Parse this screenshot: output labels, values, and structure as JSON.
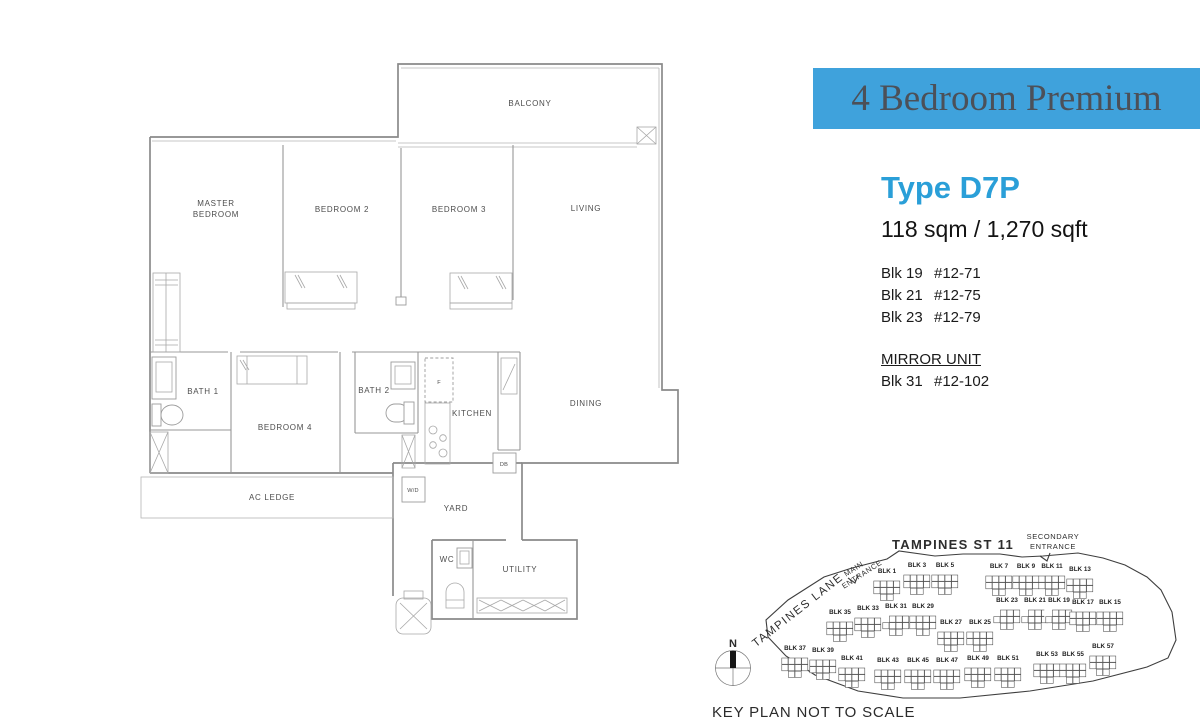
{
  "banner": {
    "title": "4 Bedroom Premium",
    "bg_color": "#3fa2dc",
    "text_color": "#4c5058"
  },
  "unit_info": {
    "type_label": "Type D7P",
    "accent_color": "#2a9fd8",
    "area": "118 sqm / 1,270 sqft",
    "blocks": [
      {
        "blk": "Blk 19",
        "unit": "#12-71"
      },
      {
        "blk": "Blk 21",
        "unit": "#12-75"
      },
      {
        "blk": "Blk 23",
        "unit": "#12-79"
      }
    ],
    "mirror_label": "MIRROR UNIT",
    "mirror_block": {
      "blk": "Blk 31",
      "unit": "#12-102"
    }
  },
  "floor_plan": {
    "labels": [
      {
        "text": "BALCONY",
        "x": 530,
        "y": 106
      },
      {
        "text": "MASTER",
        "x": 216,
        "y": 206
      },
      {
        "text": "BEDROOM",
        "x": 216,
        "y": 217
      },
      {
        "text": "BEDROOM 2",
        "x": 342,
        "y": 212
      },
      {
        "text": "BEDROOM 3",
        "x": 459,
        "y": 212
      },
      {
        "text": "LIVING",
        "x": 586,
        "y": 211
      },
      {
        "text": "BATH 1",
        "x": 203,
        "y": 394
      },
      {
        "text": "BEDROOM 4",
        "x": 285,
        "y": 430
      },
      {
        "text": "BATH 2",
        "x": 374,
        "y": 393
      },
      {
        "text": "KITCHEN",
        "x": 472,
        "y": 416
      },
      {
        "text": "DINING",
        "x": 586,
        "y": 406
      },
      {
        "text": "AC LEDGE",
        "x": 272,
        "y": 500
      },
      {
        "text": "YARD",
        "x": 456,
        "y": 511
      },
      {
        "text": "WC",
        "x": 447,
        "y": 562
      },
      {
        "text": "UTILITY",
        "x": 520,
        "y": 572
      },
      {
        "text": "F",
        "x": 439,
        "y": 384,
        "small": true
      },
      {
        "text": "W/D",
        "x": 413,
        "y": 492,
        "small": true
      },
      {
        "text": "DB",
        "x": 504,
        "y": 466,
        "small": true
      }
    ]
  },
  "key_plan": {
    "street_label": "TAMPINES ST 11",
    "secondary_entrance_l1": "SECONDARY",
    "secondary_entrance_l2": "ENTRANCE",
    "main_entrance_l1": "MAIN",
    "main_entrance_l2": "ENTRANCE",
    "lane_label": "TAMPINES LANE",
    "compass_label": "N",
    "caption": "KEY PLAN NOT TO SCALE",
    "highlight_color": "#2f9cd6",
    "rows": [
      [
        {
          "label": "BLK 1",
          "x": 887,
          "y": 573
        },
        {
          "label": "BLK 3",
          "x": 917,
          "y": 567
        },
        {
          "label": "BLK 5",
          "x": 945,
          "y": 567
        },
        {
          "label": "BLK 7",
          "x": 999,
          "y": 568
        },
        {
          "label": "BLK 9",
          "x": 1026,
          "y": 568
        },
        {
          "label": "BLK 11",
          "x": 1052,
          "y": 568
        },
        {
          "label": "BLK 13",
          "x": 1080,
          "y": 571
        }
      ],
      [
        {
          "label": "BLK 35",
          "x": 840,
          "y": 614
        },
        {
          "label": "BLK 33",
          "x": 868,
          "y": 610
        },
        {
          "label": "BLK 31",
          "x": 896,
          "y": 608,
          "highlight": true
        },
        {
          "label": "BLK 29",
          "x": 923,
          "y": 608
        },
        {
          "label": "BLK 27",
          "x": 951,
          "y": 624
        },
        {
          "label": "BLK 25",
          "x": 980,
          "y": 624
        },
        {
          "label": "BLK 23",
          "x": 1007,
          "y": 602,
          "highlight": true
        },
        {
          "label": "BLK 21",
          "x": 1035,
          "y": 602,
          "highlight": true
        },
        {
          "label": "BLK 19",
          "x": 1059,
          "y": 602,
          "highlight": true
        },
        {
          "label": "BLK 17",
          "x": 1083,
          "y": 604
        },
        {
          "label": "BLK 15",
          "x": 1110,
          "y": 604
        }
      ],
      [
        {
          "label": "BLK 37",
          "x": 795,
          "y": 650
        },
        {
          "label": "BLK 39",
          "x": 823,
          "y": 652
        },
        {
          "label": "BLK 41",
          "x": 852,
          "y": 660
        },
        {
          "label": "BLK 43",
          "x": 888,
          "y": 662
        },
        {
          "label": "BLK 45",
          "x": 918,
          "y": 662
        },
        {
          "label": "BLK 47",
          "x": 947,
          "y": 662
        },
        {
          "label": "BLK 49",
          "x": 978,
          "y": 660
        },
        {
          "label": "BLK 51",
          "x": 1008,
          "y": 660
        },
        {
          "label": "BLK 53",
          "x": 1047,
          "y": 656
        },
        {
          "label": "BLK 55",
          "x": 1073,
          "y": 656
        },
        {
          "label": "BLK 57",
          "x": 1103,
          "y": 648
        }
      ]
    ]
  }
}
